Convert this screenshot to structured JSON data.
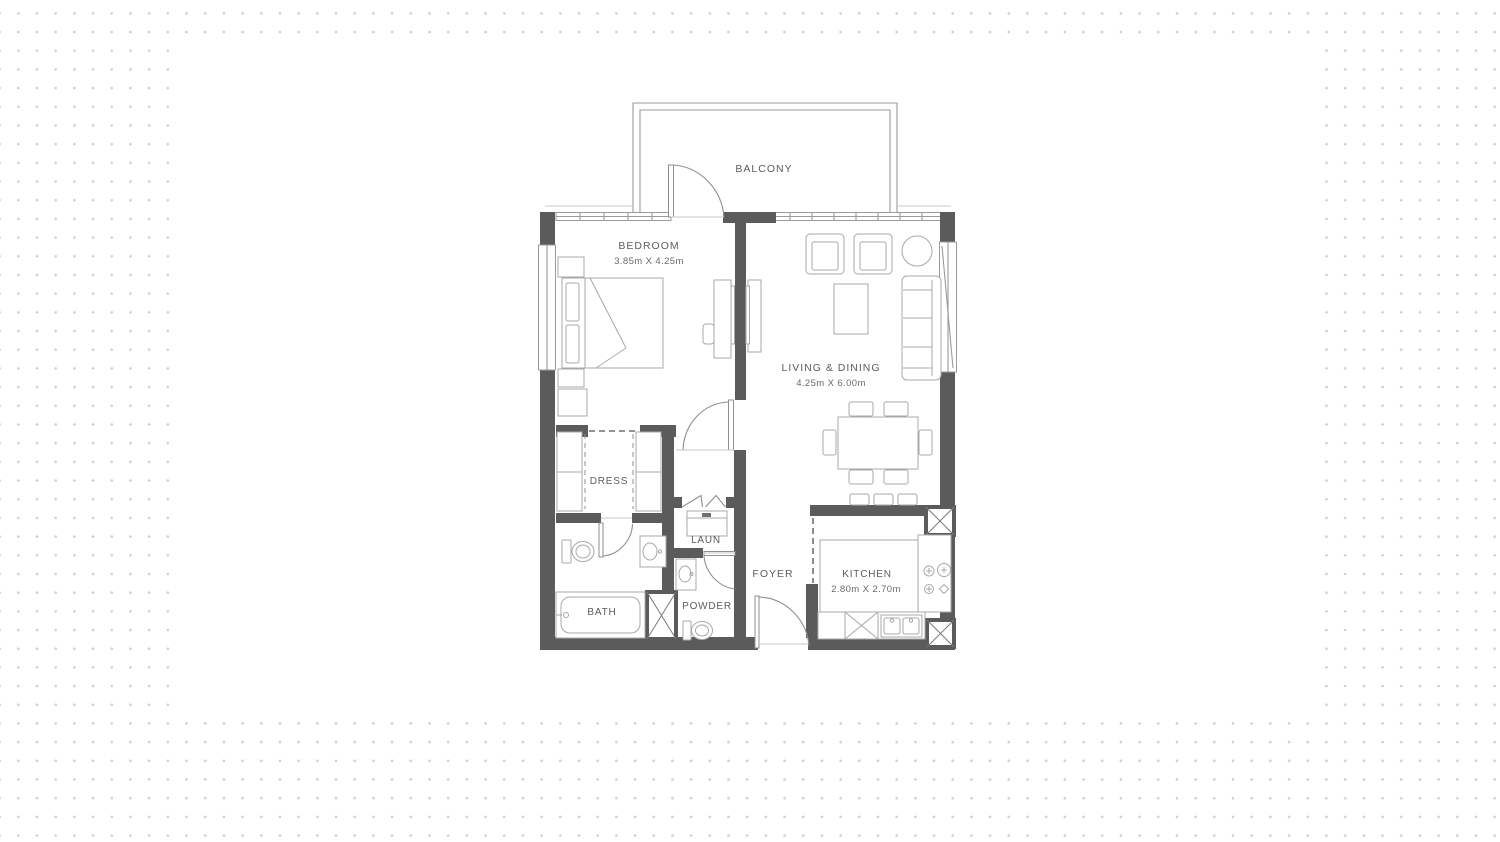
{
  "plan": {
    "type": "apartment-floor-plan",
    "rooms": [
      {
        "id": "balcony",
        "label": "BALCONY",
        "dims": ""
      },
      {
        "id": "bedroom",
        "label": "BEDROOM",
        "dims": "3.85m X 4.25m"
      },
      {
        "id": "living_dining",
        "label": "LIVING & DINING",
        "dims": "4.25m X 6.00m"
      },
      {
        "id": "dress",
        "label": "DRESS",
        "dims": ""
      },
      {
        "id": "bath",
        "label": "BATH",
        "dims": ""
      },
      {
        "id": "laundry",
        "label": "LAUN",
        "dims": ""
      },
      {
        "id": "powder",
        "label": "POWDER",
        "dims": ""
      },
      {
        "id": "foyer",
        "label": "FOYER",
        "dims": ""
      },
      {
        "id": "kitchen",
        "label": "KITCHEN",
        "dims": "2.80m X 2.70m"
      }
    ],
    "colors": {
      "wall": "#5b5b5b",
      "furniture_line": "#a8a8a8",
      "thin_line": "#9b9b9b",
      "label_text": "#5c5c5c",
      "backdrop_dot": "#cfcfcf",
      "canvas": "#ffffff"
    }
  }
}
